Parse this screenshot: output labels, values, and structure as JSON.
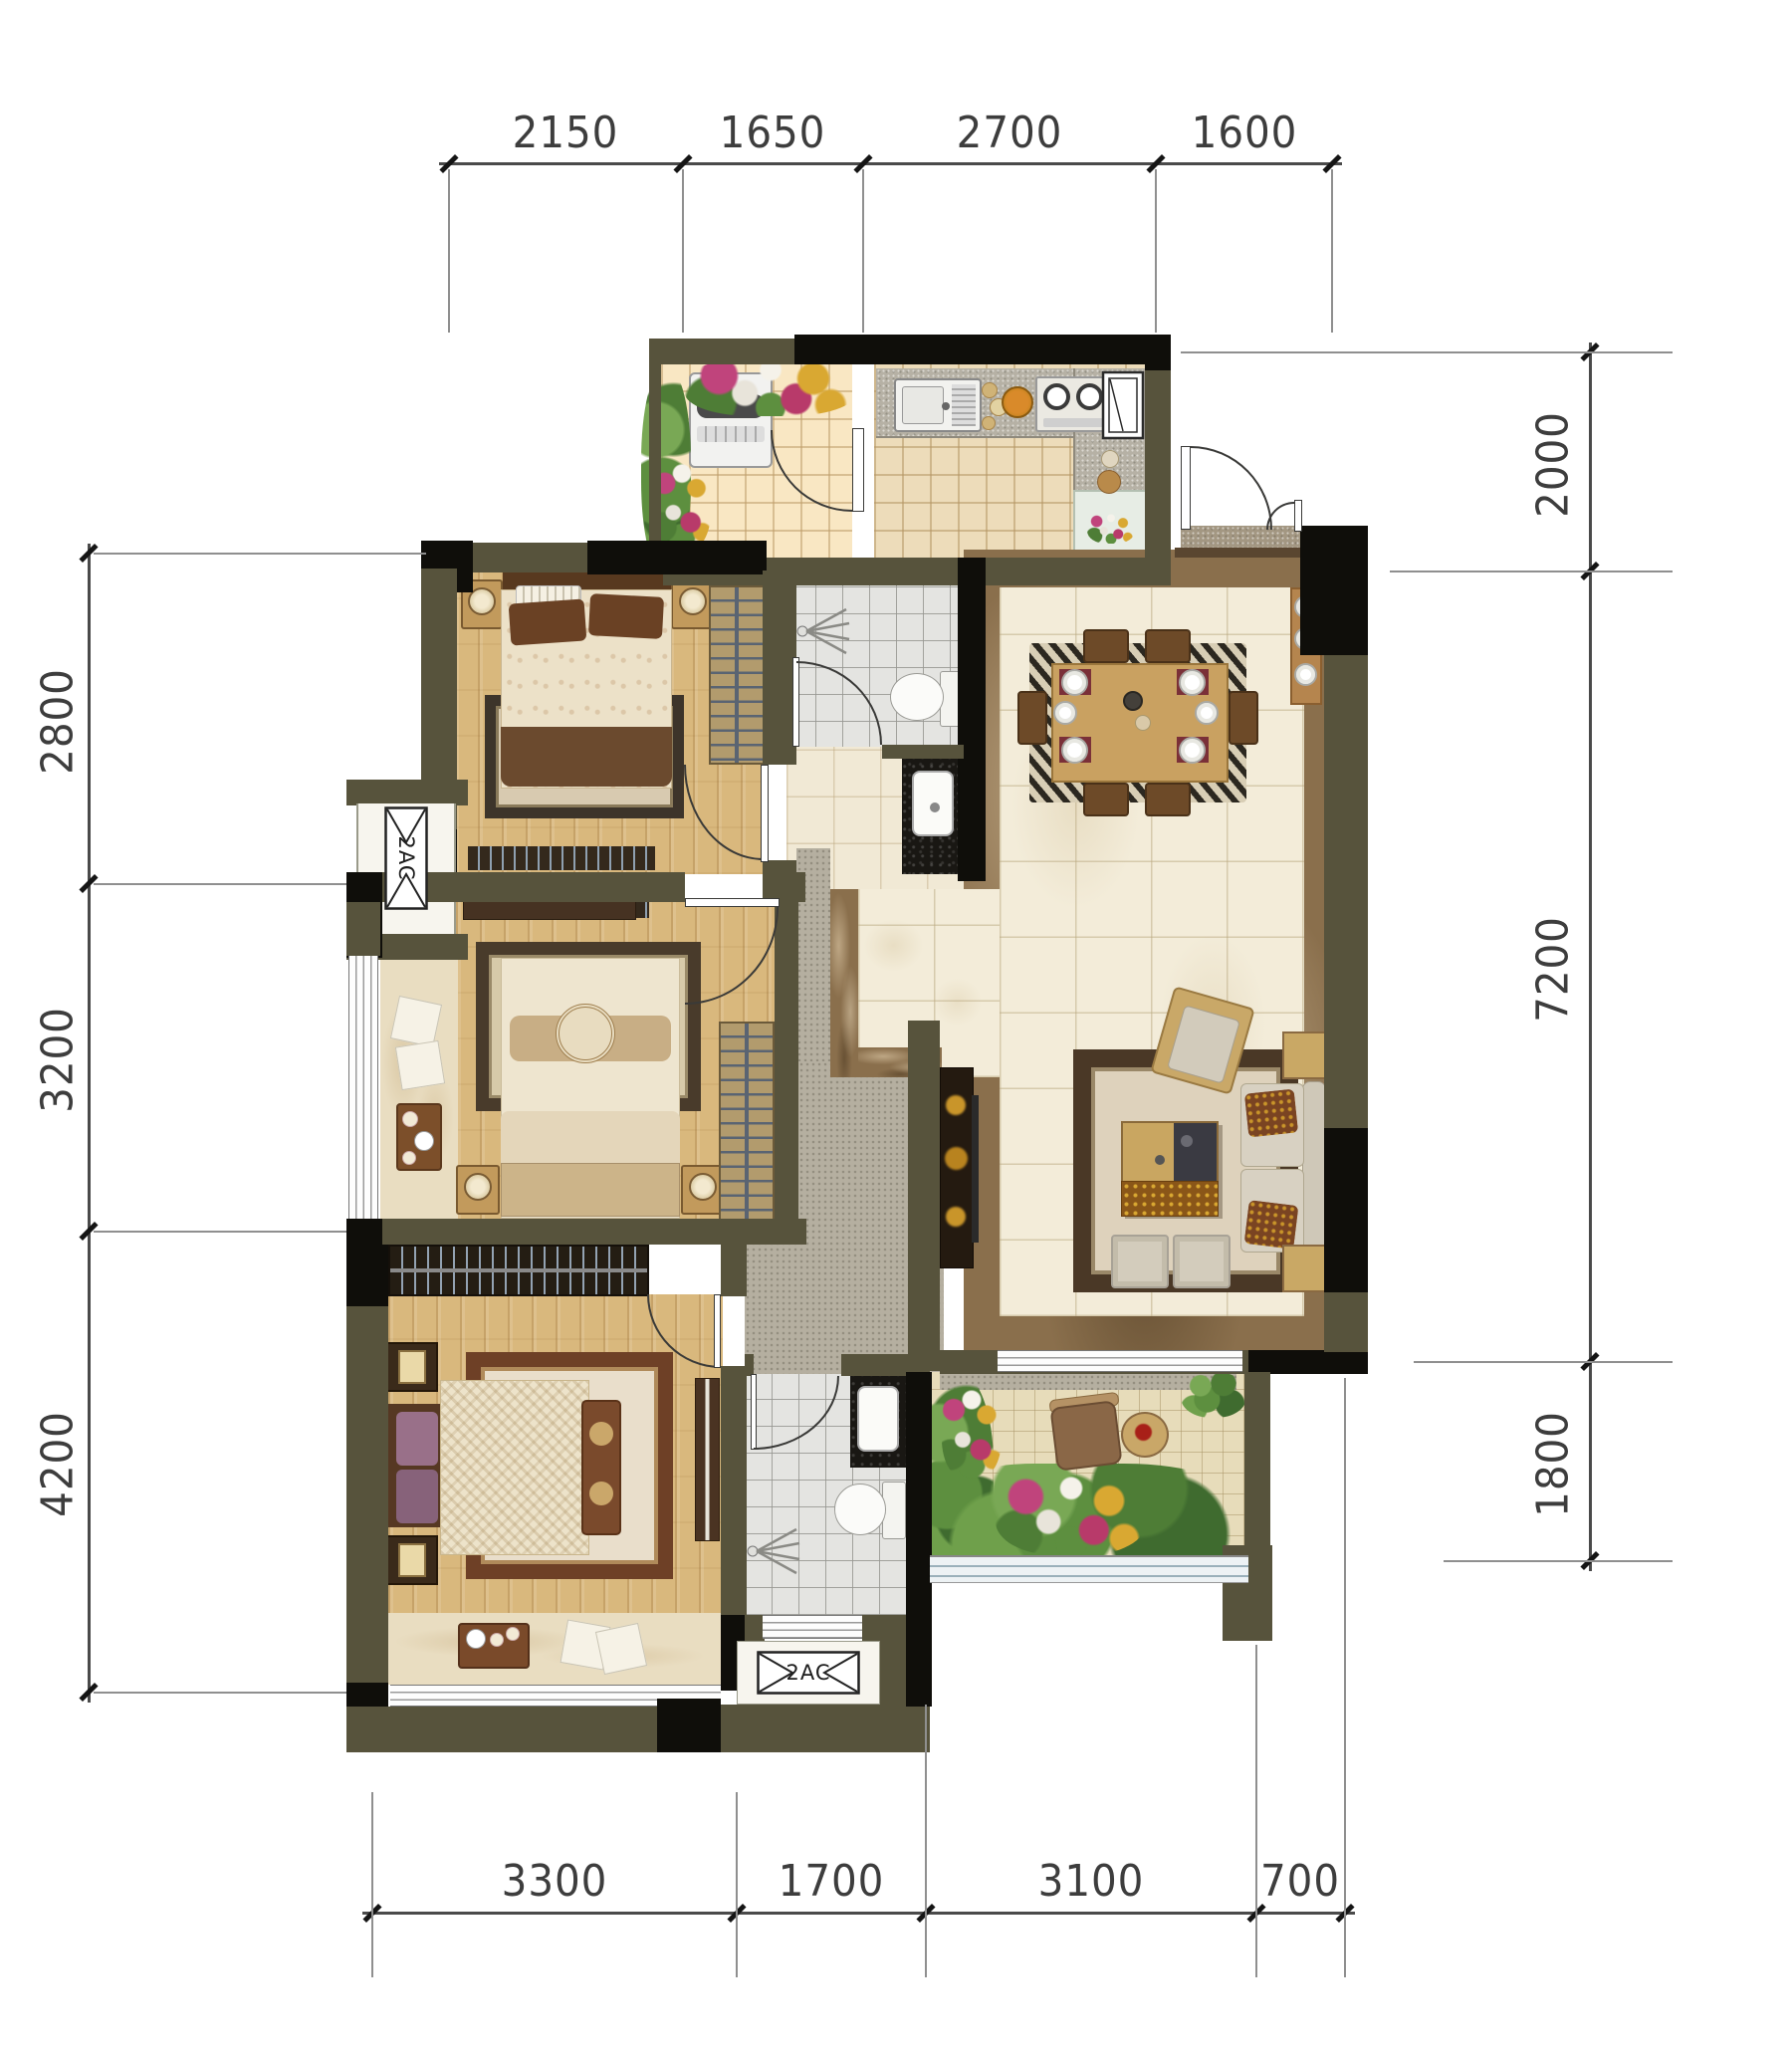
{
  "dimensions": {
    "top": [
      "2150",
      "1650",
      "2700",
      "1600"
    ],
    "left": [
      "2800",
      "3200",
      "4200"
    ],
    "right": [
      "2000",
      "7200",
      "1800"
    ],
    "bottom": [
      "3300",
      "1700",
      "3100",
      "700"
    ]
  },
  "ac_labels": {
    "left": "2AC",
    "bottom": "2AC"
  },
  "colors": {
    "wall": "#57533c",
    "column": "#0f0e0a",
    "wood_floor": "#d9b87d",
    "marble_floor": "#f3ecd9",
    "marble_border": "#8a6f4c",
    "bath_tile": "#e4e4e1",
    "kitchen_tile": "#eddcba",
    "greenery": "#5d8f3f",
    "dimension_text": "#3d3d3d"
  }
}
